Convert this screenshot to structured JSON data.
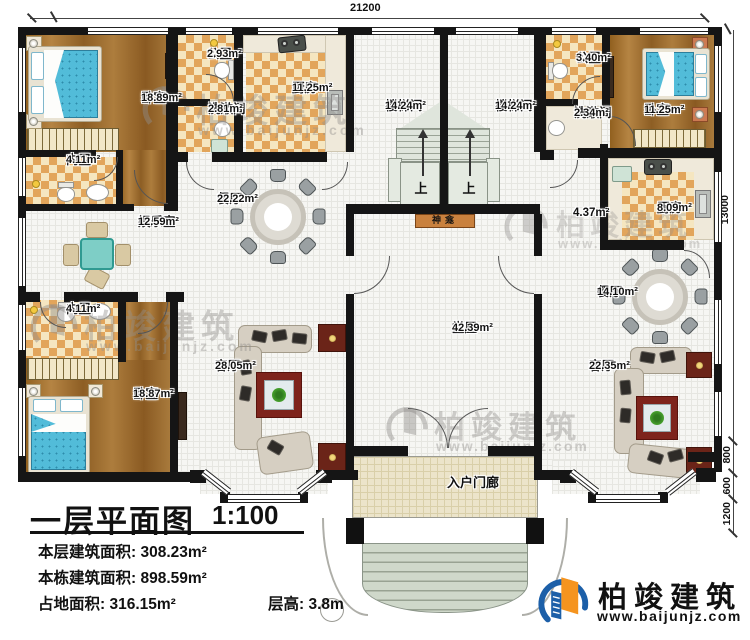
{
  "dimensions": {
    "top": "21200",
    "right": "13000",
    "right_lower": [
      "800",
      "600",
      "1200"
    ]
  },
  "rooms": [
    {
      "name": "卧室",
      "area": "18.89m²"
    },
    {
      "name": "公卫",
      "area": "2.93m²"
    },
    {
      "name": "洗漱间",
      "area": "2.81m²"
    },
    {
      "name": "厨房",
      "area": "11.25m²"
    },
    {
      "name": "楼梯间",
      "area": "14.24m²"
    },
    {
      "name": "楼梯间",
      "area": "14.24m²"
    },
    {
      "name": "公卫",
      "area": "3.40m²"
    },
    {
      "name": "洗漱间",
      "area": "2.34m²"
    },
    {
      "name": "卧室",
      "area": "11.25m²"
    },
    {
      "name": "内卫",
      "area": "4.11m²"
    },
    {
      "name": "餐厅",
      "area": "22.22m²"
    },
    {
      "name": "厨房",
      "area": "8.09m²"
    },
    {
      "name": "娱乐室",
      "area": "12.59m²"
    },
    {
      "name": "餐厅",
      "area": "14.10m²"
    },
    {
      "name": "内卫",
      "area": "4.11m²"
    },
    {
      "name": "堂屋",
      "area": "42.39m²"
    },
    {
      "name": "卧室",
      "area": "18.87m²"
    },
    {
      "name": "客厅",
      "area": "28.05m²"
    },
    {
      "name": "客厅",
      "area": "22.35m²"
    }
  ],
  "labels": {
    "up": "上",
    "shrine": "神龛",
    "porch": "入户门廊",
    "hall_area": "4.37m²"
  },
  "title": {
    "main": "一层平面图",
    "scale": "1:100",
    "stats": [
      "本层建筑面积: 308.23m²",
      "本栋建筑面积: 898.59m²",
      "占地面积: 316.15m²",
      "层高: 3.8m"
    ]
  },
  "brand": {
    "name": "柏竣建筑",
    "url": "www.baijunjz.com"
  },
  "watermark": {
    "name": "柏竣建筑",
    "url": "www.baijunjz.com"
  },
  "colors": {
    "wall_black": "#151515",
    "wood_floor": "#a2743a",
    "tile_checker": "#e2a55b",
    "floor_grid": "#f6f6f3",
    "mattress_blue": "#52bcd9",
    "rug_red": "#7e241c",
    "shrine_brown": "#c9813e",
    "steps_green": "#cfd8ca",
    "porch_tan": "#ece4ca",
    "brand_blue": "#1c5fa8",
    "brand_orange": "#f5941f"
  }
}
